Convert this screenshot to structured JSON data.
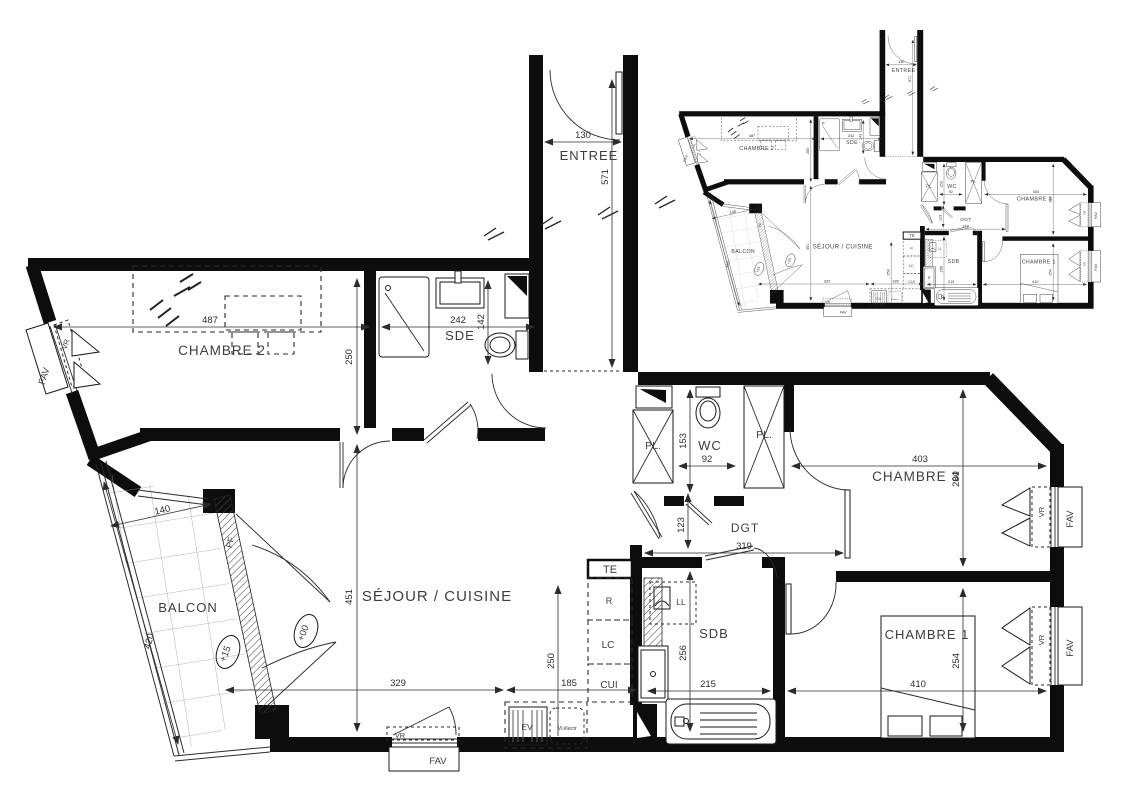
{
  "plan": {
    "labels": {
      "entree": "ENTREE",
      "chambre2": "CHAMBRE 2",
      "sde": "SDE",
      "wc": "WC",
      "chambre3": "CHAMBRE 3",
      "dgt": "DGT",
      "sejour_cuisine": "SÉJOUR / CUISINE",
      "balcon": "BALCON",
      "sdb": "SDB",
      "chambre1": "CHAMBRE 1"
    },
    "dims": {
      "entree_width": "130",
      "entree_length": "571",
      "chambre2_width": "487",
      "chambre2_depth": "250",
      "sde_width": "242",
      "sde_depth": "142",
      "wc_depth": "153",
      "wc_width": "92",
      "chambre3_width": "403",
      "chambre3_depth": "281",
      "dgt_depth": "123",
      "dgt_length": "319",
      "sejour_depth": "451",
      "cuisine_depth": "250",
      "sejour_width": "329",
      "cuisine_width": "185",
      "sdb_depth": "256",
      "sdb_width": "215",
      "chambre1_width": "410",
      "chambre1_depth": "254",
      "balcon_width": "140",
      "balcon_length": "420"
    },
    "equipment": {
      "te": "TE",
      "refrigerateur": "R",
      "lc": "LC",
      "cuisiniere": "CUI",
      "evier": "EV",
      "meuble_electr": "M.électr",
      "lave_linge": "LL",
      "placard": "PL."
    },
    "windows": {
      "fav": "FAV",
      "vr": "VR",
      "pf": "PF"
    },
    "levels": {
      "balcon_level": "+15",
      "interior_level": "+00"
    }
  }
}
